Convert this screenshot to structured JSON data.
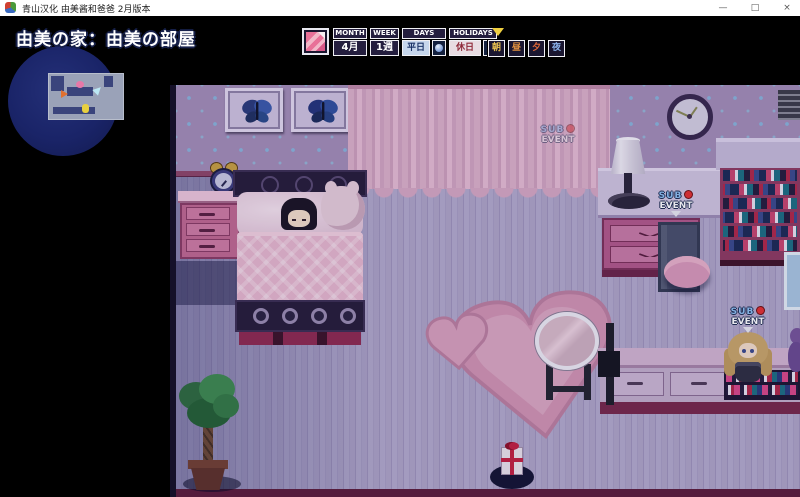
{
  "window": {
    "title": "青山汉化 由美酱和爸爸 2月版本",
    "minimize_label": "—",
    "maximize_label": "□",
    "close_label": "×"
  },
  "hud": {
    "location": "由美の家：由美の部屋",
    "calendar": {
      "month": {
        "label": "MONTH",
        "value": "4月"
      },
      "week": {
        "label": "WEEK",
        "value": "1週"
      },
      "days": {
        "label": "DAYS",
        "value": "平日"
      },
      "holidays": {
        "label": "HOLIDAYS",
        "value": "休日"
      },
      "time_slots": [
        {
          "id": "morning",
          "label": "朝"
        },
        {
          "id": "noon",
          "label": "昼"
        },
        {
          "id": "evening",
          "label": "夕"
        },
        {
          "id": "night",
          "label": "夜"
        }
      ],
      "active_slot": "朝"
    }
  },
  "events": {
    "sub_event": {
      "line1": "SUB",
      "line2": "EVENT"
    }
  },
  "colors": {
    "event_dot_red": "#e23030",
    "sub_text_blue": "#8ec0f0",
    "event_text_white": "#ffffff",
    "minimap_bg": "#1c2668",
    "wall": "#a38db6",
    "floor": "#ab9fc2",
    "accent_pink": "#c06890",
    "time_morning": "#e8c050",
    "time_noon": "#e09040",
    "time_evening": "#e06838",
    "time_night": "#8ab0e8"
  }
}
